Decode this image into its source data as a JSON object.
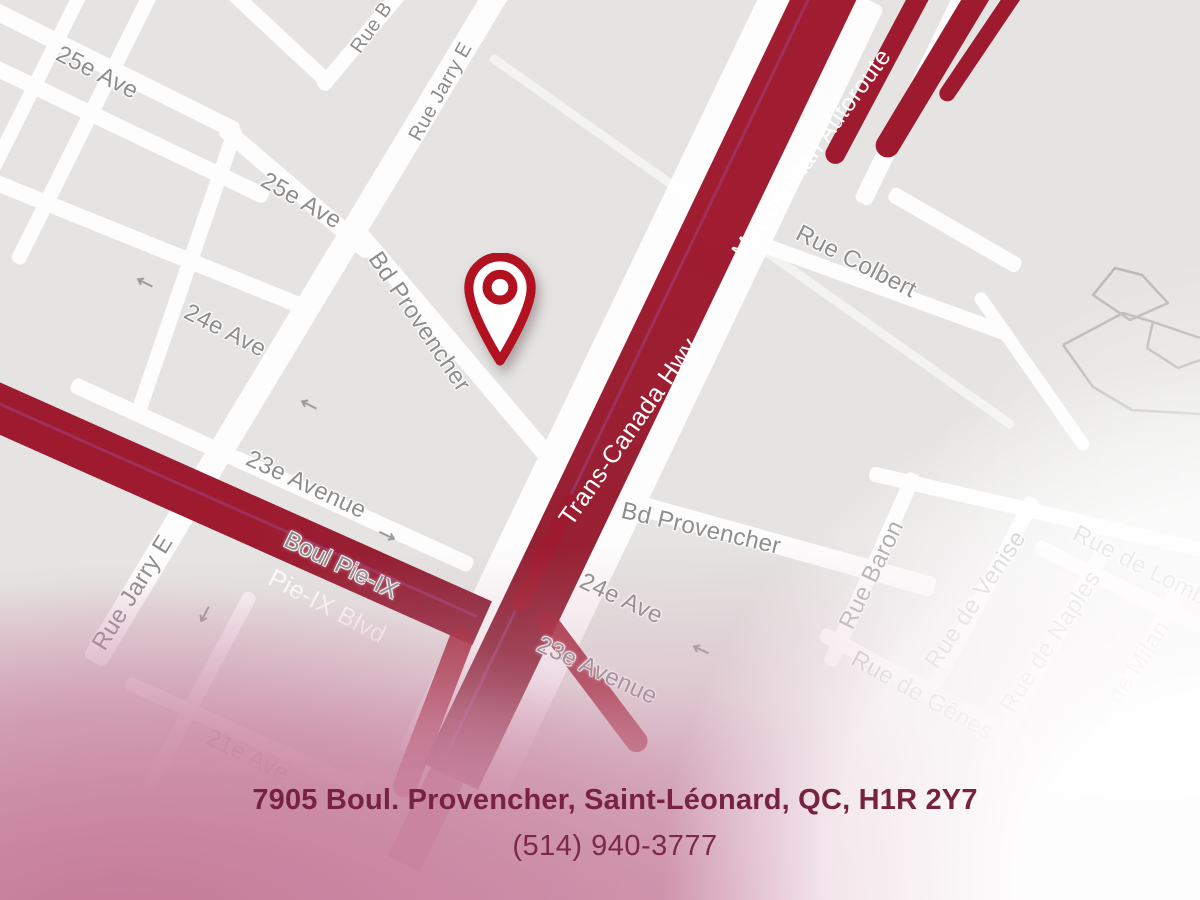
{
  "map": {
    "labels": {
      "ave25_a": "25e Ave",
      "ave25_b": "25e Ave",
      "jarry_a": "Rue Jarry E",
      "jarry_b": "Rue Jarry E",
      "provencher_a": "Bd Provencher",
      "provencher_b": "Bd Provencher",
      "ave24_a": "24e Ave",
      "ave24_b": "24e Ave",
      "ave23_a": "23e Avenue",
      "ave23_b": "23e Avenue",
      "boul_pieix": "Boul Pie-IX",
      "colbert": "Rue Colbert",
      "rue_b_partial": "Rue B",
      "baron": "Rue Baron",
      "venise": "Rue de Venise",
      "genes": "Rue de Gênes",
      "naples": "Rue de Naples",
      "milan": "Rue de Milan",
      "lombardie_partial": "Rue de Lomb",
      "ave21_faint": "21e Ave"
    },
    "highway_labels": {
      "trans_canada": "Trans-Canada Hwy",
      "metropolitan": "Metropolitan Autoroute",
      "pie_ix": "Pie-IX Blvd"
    },
    "pin_icon": "map-pin",
    "colors": {
      "map_bg": "#e5e4e2",
      "highway_red": "#9e1b2f",
      "pin_red": "#b2121f",
      "label_gray": "#8d8d8d",
      "pink_overlay": "#cf9db4",
      "address_text": "#772340"
    }
  },
  "footer": {
    "address": "7905 Boul. Provencher, Saint-Léonard, QC, H1R 2Y7",
    "phone": "(514) 940-3777"
  }
}
